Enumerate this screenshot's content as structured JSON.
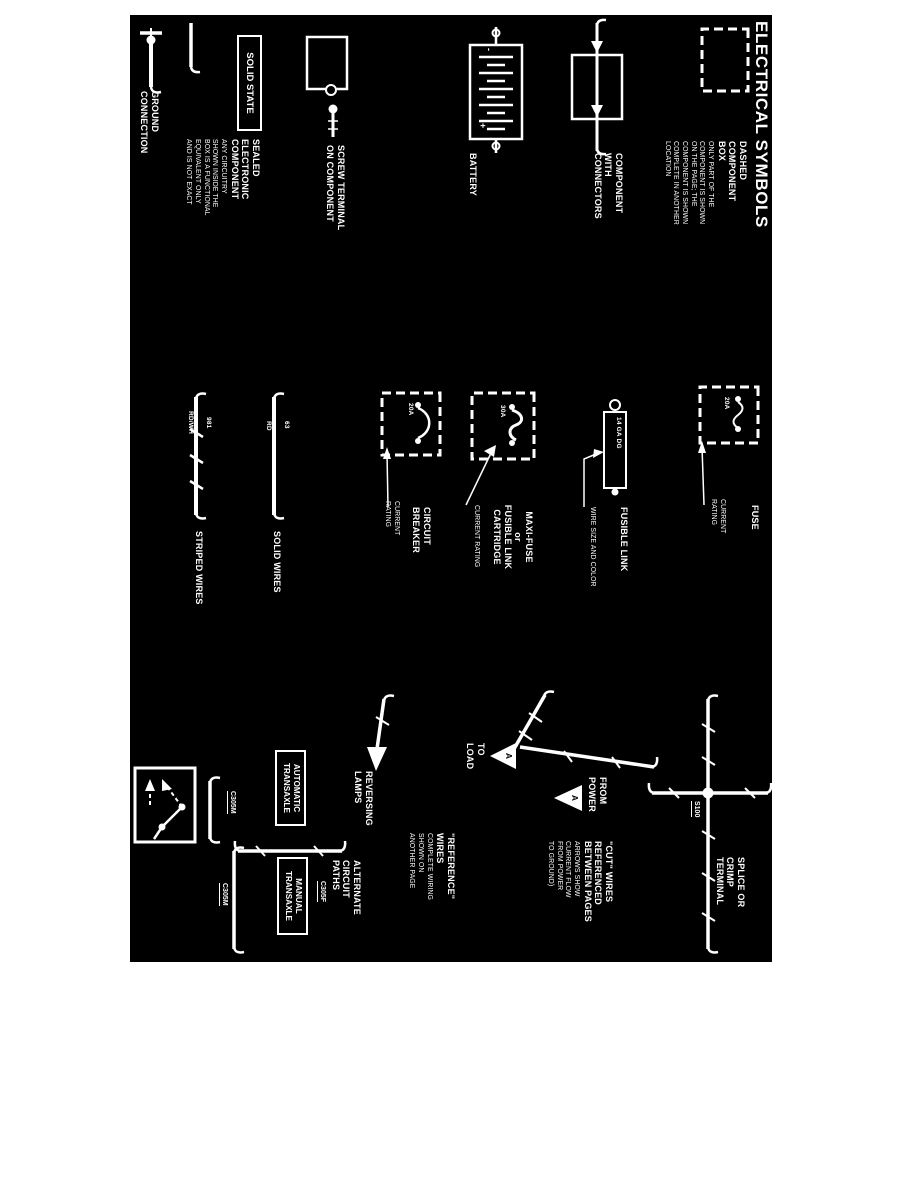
{
  "colors": {
    "page_bg": "#ffffff",
    "sheet_bg": "#000000",
    "ink": "#ffffff"
  },
  "title": "ELECTRICAL SYMBOLS",
  "legend": {
    "dashed_component_box": {
      "label": "DASHED\nCOMPONENT\nBOX",
      "desc": "ONLY PART OF THE\nCOMPONENT IS SHOWN\nON THE PAGE; THE\nCOMPONENT IS SHOWN\nCOMPLETE IN ANOTHER\nLOCATION"
    },
    "component_with_connectors": {
      "label": "COMPONENT\nWITH\nCONNECTORS"
    },
    "battery": {
      "label": "BATTERY",
      "plus": "+",
      "minus": "-"
    },
    "screw_terminal": {
      "label": "SCREW TERMINAL\nON COMPONENT"
    },
    "solid_state": {
      "box_label": "SOLID STATE",
      "label": "SEALED\nELECTRONIC\nCOMPONENT",
      "desc": "ANY CIRCUITRY\nSHOWN INSIDE THE\nBOX IS A FUNCTIONAL\nEQUIVALENT ONLY\nAND IS NOT EXACT"
    },
    "ground_connection": {
      "label": "GROUND\nCONNECTION"
    },
    "fuse": {
      "label": "FUSE",
      "rating": "20A",
      "note": "CURRENT\nRATING"
    },
    "fusible_link": {
      "label": "FUSIBLE LINK",
      "value": "14 GA DG",
      "note": "WIRE SIZE AND COLOR"
    },
    "maxi_fuse": {
      "label": "MAXI-FUSE\nor\nFUSIBLE LINK\nCARTRIDGE",
      "rating": "30A",
      "note": "CURRENT RATING"
    },
    "circuit_breaker": {
      "label": "CIRCUIT\nBREAKER",
      "rating": "20A",
      "note": "CURRENT\nRATING"
    },
    "solid_wires": {
      "label": "SOLID WIRES",
      "circuit": "63",
      "color": "RD"
    },
    "striped_wires": {
      "label": "STRIPED WIRES",
      "circuit": "981",
      "color": "RD/WH"
    },
    "splice": {
      "label": "SPLICE OR\nCRIMP\nTERMINAL",
      "id": "S100"
    },
    "cut_wires": {
      "label": "\"CUT\" WIRES\nREFERENCED\nBETWEEN PAGES",
      "desc": "ARROWS SHOW\nCURRENT FLOW\nFROM POWER\nTO GROUND)",
      "from_power": "FROM\nPOWER",
      "to_load": "TO\nLOAD",
      "letter": "A"
    },
    "reference_wires": {
      "label": "\"REFERENCE\"\nWIRES",
      "desc": "COMPLETE WIRING\nSHOWN ON\nANOTHER PAGE",
      "example": "REVERSING\nLAMPS"
    },
    "alternate_paths": {
      "label": "ALTERNATE\nCIRCUIT\nPATHS",
      "auto_box": "AUTOMATIC\nTRANSAXLE",
      "manual_box": "MANUAL\nTRANSAXLE",
      "conn_f": "C305F",
      "conn_m1": "C305M",
      "conn_m2": "C305M"
    }
  }
}
